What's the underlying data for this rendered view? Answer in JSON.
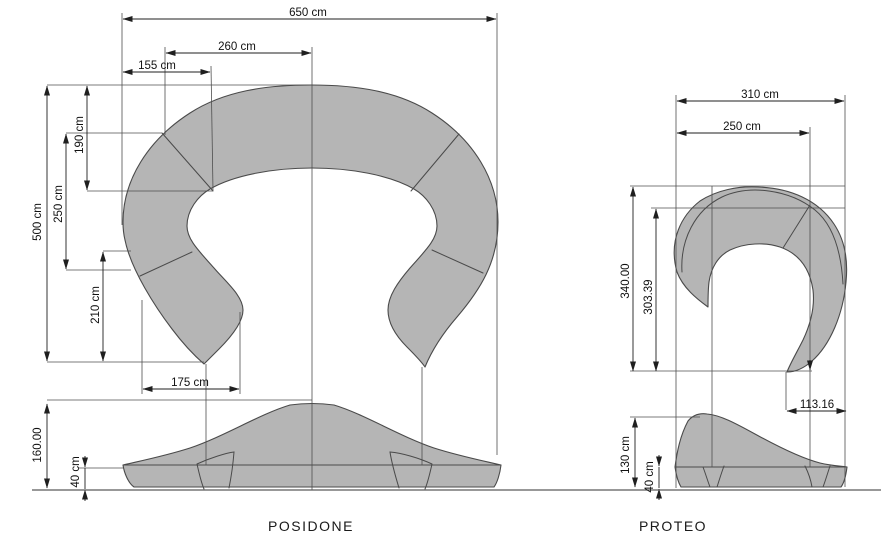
{
  "drawing_title": "Sofa dimensional drawing",
  "colors": {
    "background": "#ffffff",
    "shape_fill": "#b5b5b5",
    "outline": "#4a4a4a",
    "dimension_line": "#1f1f1f",
    "text": "#111111"
  },
  "posidone": {
    "title": "POSIDONE",
    "dims": {
      "overall_width": "650 cm",
      "upper_width": "260 cm",
      "upper_left_width": "155 cm",
      "overall_depth": "500 cm",
      "back_depth": "190 cm",
      "mid_depth": "250 cm",
      "front_depth": "210 cm",
      "seat_width": "175 cm",
      "height": "160.00",
      "base_height": "40 cm"
    }
  },
  "proteo": {
    "title": "PROTEO",
    "dims": {
      "overall_width": "310 cm",
      "inner_width": "250 cm",
      "overall_depth": "340.00",
      "inner_depth": "303.39",
      "tip_offset": "113.16",
      "height": "130 cm",
      "base_height": "40 cm"
    }
  }
}
